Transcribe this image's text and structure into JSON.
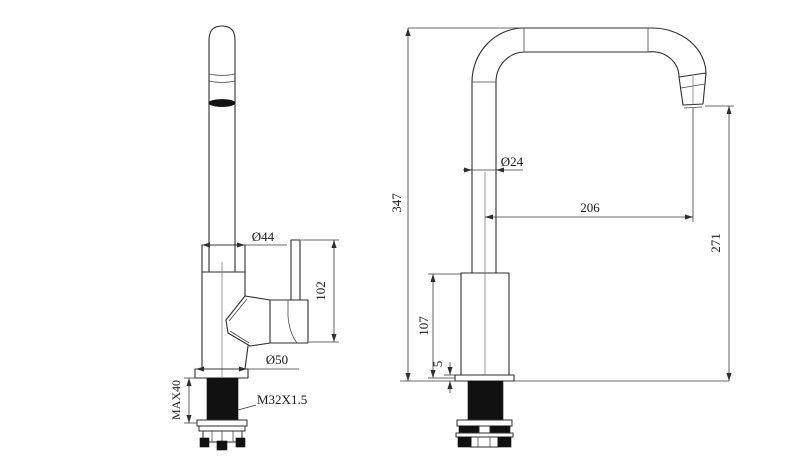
{
  "drawing": {
    "title": "kitchen-faucet-dimension-drawing",
    "front_view": {
      "dims": {
        "body_diameter": "Ø44",
        "handle_height": "102",
        "base_diameter": "Ø50",
        "max_mount_thickness": "MAX40",
        "thread_spec": "M32X1.5"
      }
    },
    "side_view": {
      "dims": {
        "total_height": "347",
        "tube_diameter": "Ø24",
        "spout_reach": "206",
        "spout_clearance": "271",
        "body_height": "107",
        "flange_thickness": "5"
      }
    },
    "colors": {
      "line": "#2e2e2e",
      "background": "#ffffff",
      "fill_dark": "#111111"
    }
  }
}
